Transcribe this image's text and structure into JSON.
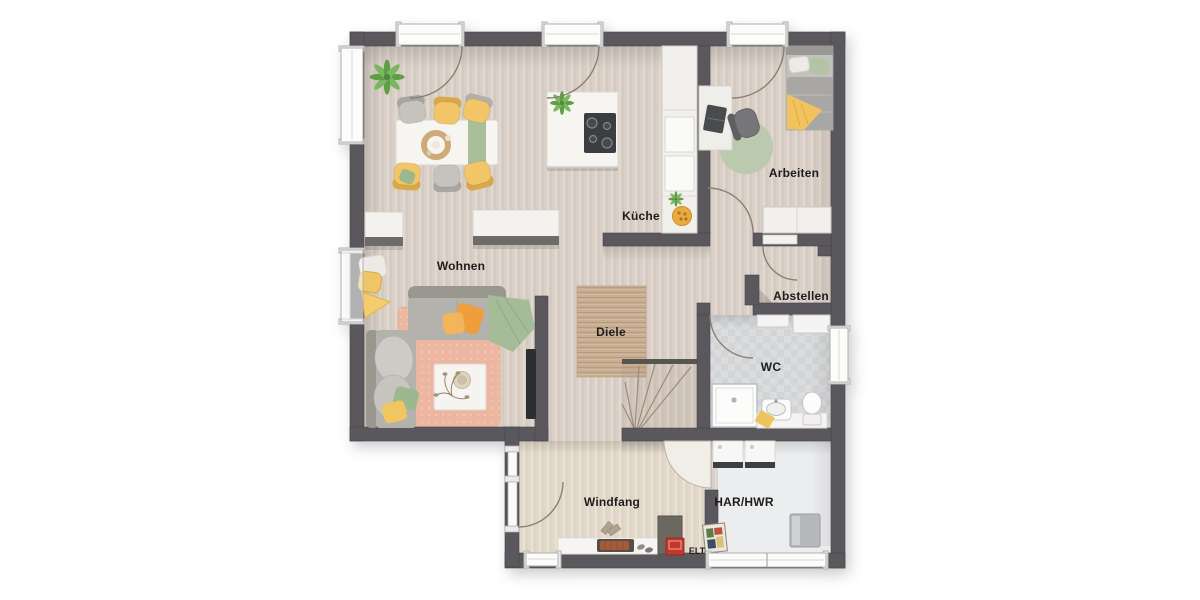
{
  "rooms": {
    "wohnen": "Wohnen",
    "kueche": "Küche",
    "arbeiten": "Arbeiten",
    "abstellen": "Abstellen",
    "wc": "WC",
    "diele": "Diele",
    "windfang": "Windfang",
    "har_hwr": "HAR/HWR",
    "elt": "ELT"
  },
  "palette": {
    "wall": "#5a595b",
    "floor_wood": "#d9cfc6",
    "floor_windfang": "#e2d8c9",
    "floor_wc_tile": "#d6d8da",
    "floor_har": "#ecedee",
    "rug_living": "#ecb6a0",
    "rug_diele": "#c9ae92",
    "accent_yellow": "#f0c25e",
    "accent_orange": "#ee9e3c",
    "accent_green": "#9cb88f",
    "elt_red": "#c4392b",
    "furniture_white": "#f4f2ef"
  }
}
